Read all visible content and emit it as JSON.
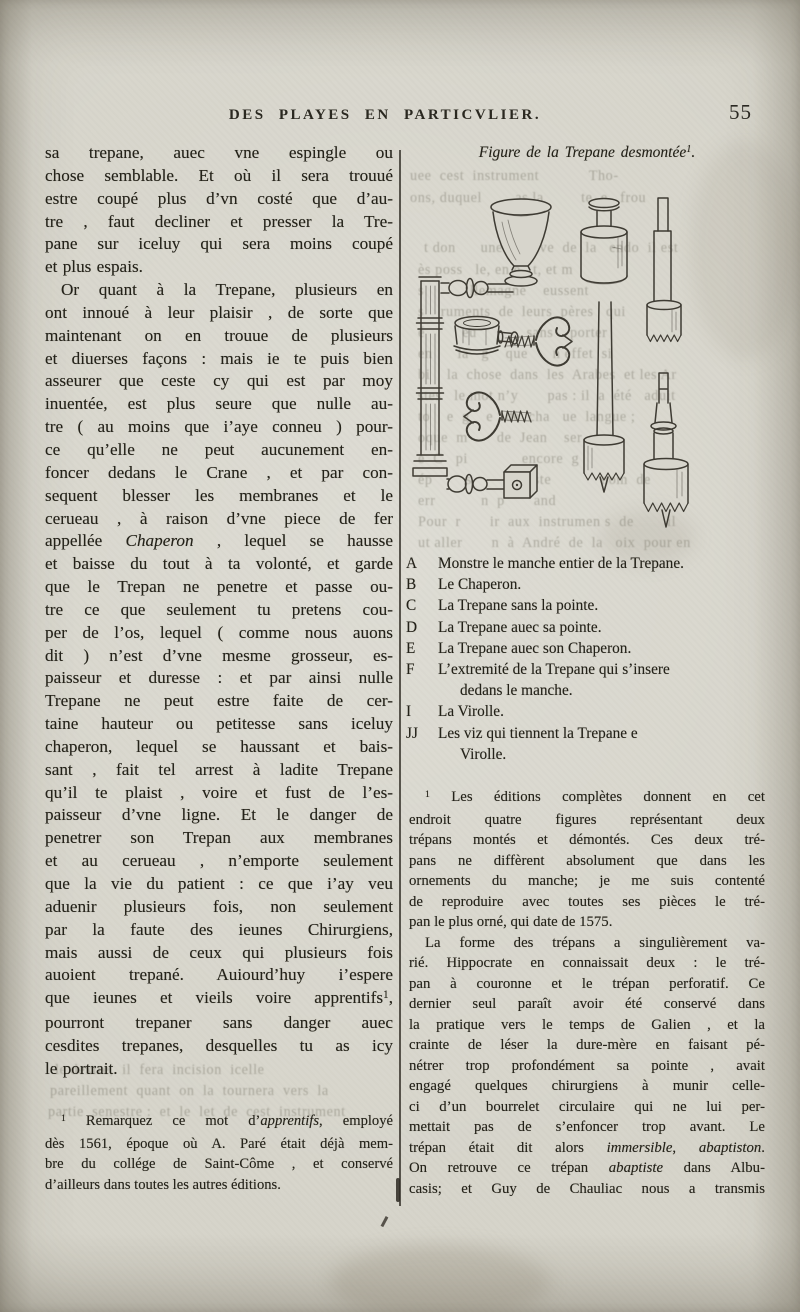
{
  "page": {
    "header": {
      "title": "DES PLAYES EN PARTICVLIER.",
      "page_number": "55"
    },
    "left_column": {
      "lines": [
        {
          "runs": "sa trepane, auec vne espingle ou"
        },
        {
          "runs": "chose semblable. Et où il sera trouué"
        },
        {
          "runs": "estre coupé plus d’vn costé que d’au-"
        },
        {
          "runs": "tre , faut decliner et presser la Tre-"
        },
        {
          "runs": "pane sur iceluy qui sera moins coupé"
        },
        {
          "runs": "et plus espais.",
          "end": true
        },
        {
          "runs": "Or quant à la Trepane, plusieurs en",
          "in": true
        },
        {
          "runs": "ont innoué à leur plaisir , de sorte que"
        },
        {
          "runs": "maintenant on en trouue de plusieurs"
        },
        {
          "runs": "et diuerses façons : mais ie te puis bien"
        },
        {
          "runs": "asseurer que ceste cy qui est par moy"
        },
        {
          "runs": "inuentée, est plus seure que nulle au-"
        },
        {
          "runs": "tre ( au moins que i’aye conneu ) pour-"
        },
        {
          "runs": "ce qu’elle ne peut aucunement en-"
        },
        {
          "runs": "foncer dedans le Crane , et par con-"
        },
        {
          "runs": "sequent blesser les membranes et le"
        },
        {
          "runs": "cerueau , à raison d’vne piece de fer"
        },
        {
          "runs": [
            {
              "t": "appellée "
            },
            {
              "t": "Chaperon",
              "i": true
            },
            {
              "t": " , lequel se hausse"
            }
          ]
        },
        {
          "runs": "et baisse du tout à ta volonté, et garde"
        },
        {
          "runs": "que le Trepan ne penetre et passe ou-"
        },
        {
          "runs": "tre ce que seulement tu pretens cou-"
        },
        {
          "runs": "per de l’os, lequel ( comme nous auons"
        },
        {
          "runs": "dit ) n’est d’vne mesme grosseur, es-"
        },
        {
          "runs": "paisseur et duresse : et par ainsi nulle"
        },
        {
          "runs": "Trepane ne peut estre faite de cer-"
        },
        {
          "runs": "taine hauteur ou petitesse sans iceluy"
        },
        {
          "runs": "chaperon, lequel se haussant et bais-"
        },
        {
          "runs": "sant , fait tel arrest à ladite Trepane"
        },
        {
          "runs": "qu’il te plaist , voire et fust de l’es-"
        },
        {
          "runs": "paisseur d’vne ligne. Et le danger de"
        },
        {
          "runs": "penetrer son Trepan aux membranes"
        },
        {
          "runs": "et au cerueau , n’emporte seulement"
        },
        {
          "runs": "que la vie du patient : ce que i’ay veu"
        },
        {
          "runs": "aduenir plusieurs fois, non seulement"
        },
        {
          "runs": "par la faute des ieunes Chirurgiens,"
        },
        {
          "runs": "mais aussi de ceux qui plusieurs fois"
        },
        {
          "runs": "auoient trepané. Auiourd’huy i’espere"
        },
        {
          "runs": [
            {
              "t": "que ieunes et vieils voire apprentifs"
            },
            {
              "t": "1",
              "sup": true
            },
            {
              "t": ","
            }
          ]
        },
        {
          "runs": "pourront trepaner sans danger auec"
        },
        {
          "runs": "cesdites trepanes, desquelles tu as icy"
        },
        {
          "runs": "le portrait.",
          "end": true
        }
      ],
      "footnote_lines": [
        {
          "runs": [
            {
              "t": "1",
              "sup": true
            },
            {
              "t": " Remarquez ce mot d’"
            },
            {
              "t": "apprentifs",
              "i": true
            },
            {
              "t": ", employé"
            }
          ],
          "in": true
        },
        {
          "runs": "dès 1561, époque où A. Paré était déjà mem-"
        },
        {
          "runs": "bre du collége de Saint-Côme , et conservé"
        },
        {
          "runs": "d’ailleurs dans toutes les autres éditions.",
          "end": true
        }
      ]
    },
    "right_column": {
      "caption": "Figure de la Trepane desmontée",
      "caption_note": "1",
      "caption_end": ".",
      "figure_labels": [
        {
          "t": "A",
          "x": 489,
          "y": 238
        },
        {
          "t": "B",
          "x": 569,
          "y": 243
        },
        {
          "t": "C",
          "x": 632,
          "y": 313
        },
        {
          "t": "D",
          "x": 574,
          "y": 446
        },
        {
          "t": "E",
          "x": 631,
          "y": 480
        },
        {
          "t": "F",
          "x": 644,
          "y": 377
        },
        {
          "t": "I",
          "x": 441,
          "y": 327
        },
        {
          "t": "J",
          "x": 531,
          "y": 311
        },
        {
          "t": "J",
          "x": 492,
          "y": 393
        }
      ],
      "legend": [
        {
          "key": "A",
          "line1": "Monstre le manche entier de la Trepane."
        },
        {
          "key": "B",
          "line1": "Le Chaperon."
        },
        {
          "key": "C",
          "line1": "La Trepane sans la pointe."
        },
        {
          "key": "D",
          "line1": "La Trepane auec sa pointe."
        },
        {
          "key": "E",
          "line1": "La Trepane auec son Chaperon."
        },
        {
          "key": "F",
          "line1": "L’extremité de la Trepane qui s’insere",
          "line2": "dedans le manche."
        },
        {
          "key": "I",
          "line1": "La Virolle."
        },
        {
          "key": "JJ",
          "line1": "Les viz qui tiennent la Trepane e",
          "line2": "Virolle."
        }
      ],
      "footnote_lines": [
        {
          "runs": [
            {
              "t": "1",
              "sup": true
            },
            {
              "t": " Les éditions complètes donnent en cet"
            }
          ],
          "in": true
        },
        {
          "runs": "endroit quatre figures représentant deux"
        },
        {
          "runs": "trépans montés et démontés. Ces deux tré-"
        },
        {
          "runs": "pans ne diffèrent absolument que dans les"
        },
        {
          "runs": "ornements du manche; je me suis contenté"
        },
        {
          "runs": "de reproduire avec toutes ses pièces le tré-"
        },
        {
          "runs": "pan le plus orné, qui date de 1575.",
          "end": true
        },
        {
          "runs": "La forme des trépans a singulièrement va-",
          "in": true
        },
        {
          "runs": "rié. Hippocrate en connaissait deux : le tré-"
        },
        {
          "runs": "pan à couronne et le trépan perforatif. Ce"
        },
        {
          "runs": "dernier seul paraît avoir été conservé dans"
        },
        {
          "runs": "la pratique vers le temps de Galien , et la"
        },
        {
          "runs": "crainte de léser la dure-mère en faisant pé-"
        },
        {
          "runs": "nétrer trop profondément sa pointe , avait"
        },
        {
          "runs": "engagé quelques chirurgiens à munir celle-"
        },
        {
          "runs": "ci d’un bourrelet circulaire qui ne lui per-"
        },
        {
          "runs": "mettait pas de s’enfoncer trop avant. Le"
        },
        {
          "runs": [
            {
              "t": "trépan était dit alors "
            },
            {
              "t": "immersible",
              "i": true
            },
            {
              "t": ", "
            },
            {
              "t": "abaptiston",
              "i": true
            },
            {
              "t": "."
            }
          ]
        },
        {
          "runs": [
            {
              "t": "On retrouve ce trépan "
            },
            {
              "t": "abaptiste",
              "i": true
            },
            {
              "t": " dans Albu-"
            }
          ]
        },
        {
          "runs": "casis; et Guy de Chauliac nous a transmis"
        }
      ]
    },
    "ghost_fragments": [
      {
        "t": "uee  cest  instrument            Tho-",
        "x": 410,
        "y": 168,
        "w": 350
      },
      {
        "t": "ons, duquel        as la         te  e   frou",
        "x": 410,
        "y": 190,
        "w": 350
      },
      {
        "t": "t don      une       uve  de  la   endo  il est",
        "x": 424,
        "y": 240,
        "w": 340
      },
      {
        "t": "ès poss   le, en e   t, et m",
        "x": 418,
        "y": 262,
        "w": 340
      },
      {
        "t": "s           llemagne    eussent",
        "x": 418,
        "y": 283,
        "w": 340
      },
      {
        "t": "s    ruments  de  leurs  pères   qui",
        "x": 418,
        "y": 304,
        "w": 340
      },
      {
        "t": "é         eu            sans    porter",
        "x": 418,
        "y": 325,
        "w": 340
      },
      {
        "t": "en      la   g    que      n effet  si",
        "x": 418,
        "y": 346,
        "w": 340
      },
      {
        "t": "bi    la  chose  dans  les  Arabes  et les Ar",
        "x": 418,
        "y": 367,
        "w": 340
      },
      {
        "t": "stes   le mot n’y       pas : il  a  été   aduit",
        "x": 418,
        "y": 388,
        "w": 340
      },
      {
        "t": "to    e  g    e   de  cha   ue  langue ;",
        "x": 418,
        "y": 409,
        "w": 340
      },
      {
        "t": "oque  m       de  Jean    ser   s",
        "x": 418,
        "y": 430,
        "w": 340
      },
      {
        "t": "e  C   pi             encore  g",
        "x": 418,
        "y": 451,
        "w": 340
      },
      {
        "t": "ép        s         optiste            nom  de",
        "x": 418,
        "y": 472,
        "w": 340
      },
      {
        "t": "err           n  p       and",
        "x": 418,
        "y": 493,
        "w": 340
      },
      {
        "t": "Pour  r       ir  aux  instrumen s  de        il",
        "x": 418,
        "y": 514,
        "w": 340
      },
      {
        "t": "ut aller       n  à  André  de  la   oix  pour en",
        "x": 418,
        "y": 535,
        "w": 340
      },
      {
        "t": "le dextre,  il  fera  incision  icelle",
        "x": 55,
        "y": 1062,
        "w": 340
      },
      {
        "t": "pareillement  quant  on  la  tournera  vers  la",
        "x": 50,
        "y": 1083,
        "w": 345
      },
      {
        "t": "partie  senestre :  et  le  let  de  cest  instrument",
        "x": 48,
        "y": 1104,
        "w": 348
      }
    ]
  }
}
